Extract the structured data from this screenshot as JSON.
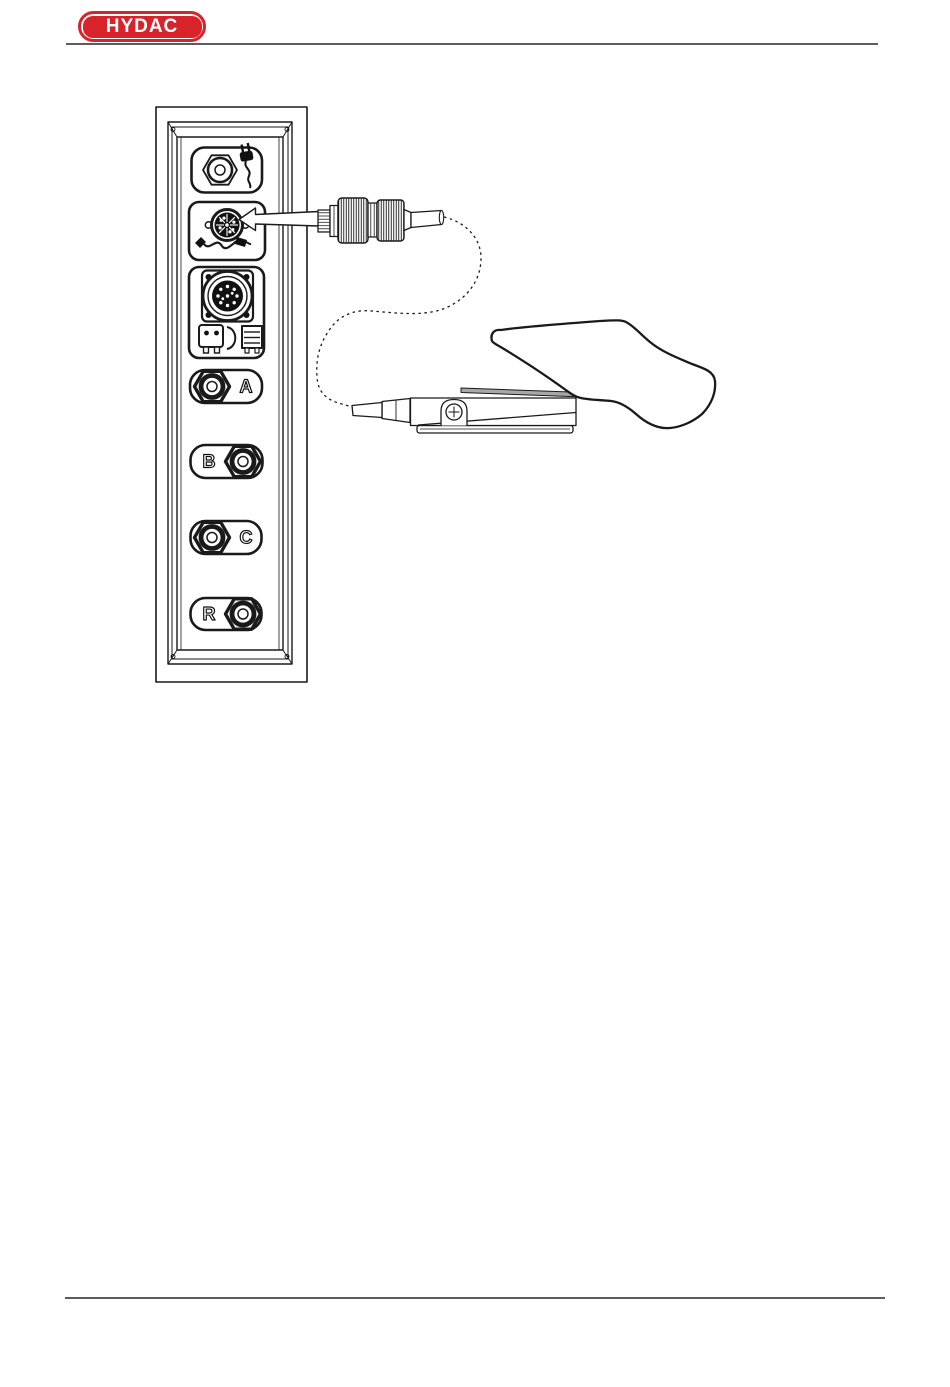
{
  "colors": {
    "brand_red": "#d9232a",
    "ink": "#1a1a1a",
    "rule_gray": "#5c5c5c",
    "pedal_band_gray": "#a8a8a8"
  },
  "header": {
    "logo_text": "HYDAC"
  },
  "diagram": {
    "panel": {
      "sockets": [
        {
          "name": "power-socket",
          "icons": [
            "hex-nut-connector-icon",
            "power-plug-icon"
          ],
          "label": ""
        },
        {
          "name": "footswitch-socket",
          "icons": [
            "din-connector-icon",
            "cable-icon"
          ],
          "label": ""
        },
        {
          "name": "interface-socket",
          "icons": [
            "multipin-connector-icon",
            "plug-loop-printer-icon"
          ],
          "label": ""
        },
        {
          "name": "measuring-port-a",
          "icons": [
            "hex-nut-connector-icon"
          ],
          "label": "A"
        },
        {
          "name": "measuring-port-b",
          "icons": [
            "hex-nut-connector-icon"
          ],
          "label": "B"
        },
        {
          "name": "measuring-port-c",
          "icons": [
            "hex-nut-connector-icon"
          ],
          "label": "C"
        },
        {
          "name": "measuring-port-r",
          "icons": [
            "hex-nut-connector-icon"
          ],
          "label": "R"
        }
      ]
    }
  }
}
